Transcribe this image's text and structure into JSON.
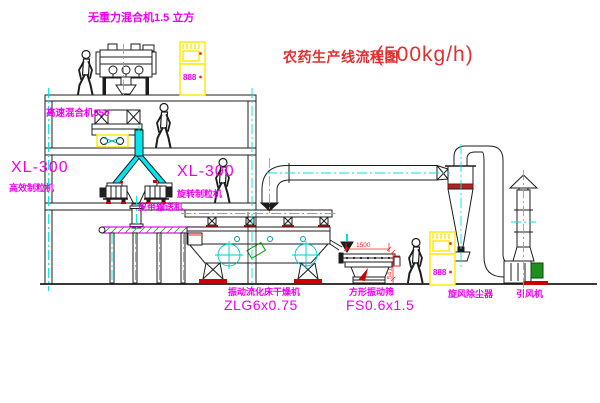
{
  "diagram": {
    "title": "农药生产线流程图",
    "title_capacity": "(500kg/h)"
  },
  "equipment": {
    "gravity_mixer": "无重力混合机1.5 立方",
    "high_speed_mixer": "高速混合机350",
    "granulator_left": {
      "model": "XL-300",
      "name": "高效制粒机"
    },
    "granulator_right": {
      "model": "XL-300",
      "name": "旋转制粒机"
    },
    "belt_conveyor": "皮带输送机",
    "fluid_bed_dryer": {
      "name": "振动流化床干燥机",
      "model": "ZLG6x0.75"
    },
    "vibrating_screen": {
      "name": "方形振动筛",
      "model": "FS0.6x1.5"
    },
    "cyclone": "旋风除尘器",
    "fan": "引风机"
  },
  "dimensions": {
    "screen_length": "1500",
    "screen_height": "541"
  },
  "control_cabinet": {
    "display": "888"
  },
  "colors": {
    "label_magenta": "#ee00ee",
    "title_red": "#e03030",
    "dimension_red": "#ff2020",
    "centerline_cyan": "#00e0e0",
    "cabinet_yellow": "#ffe800",
    "hatch_green": "#00a000",
    "motor_green": "#1f8f1f",
    "line_black": "#1c1c1c",
    "cyclone_band_red": "#b22222",
    "background": "#ffffff"
  }
}
